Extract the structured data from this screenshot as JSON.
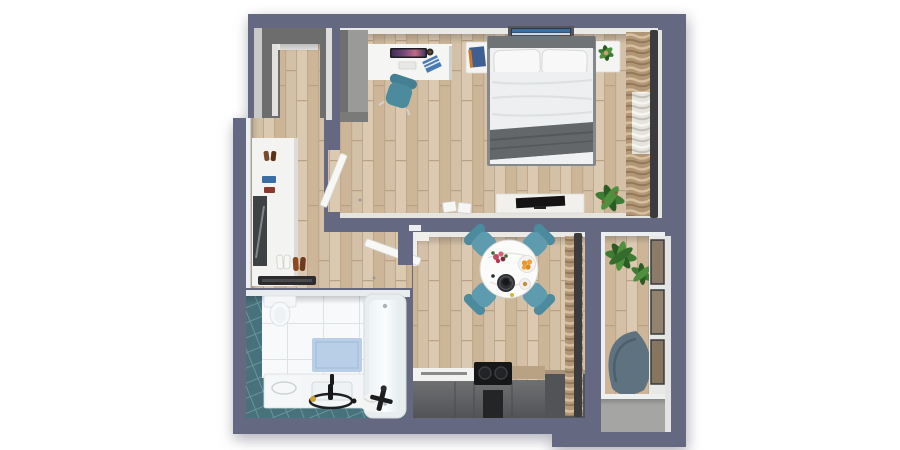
{
  "scene": {
    "name": "apartment-floor-plan-3d-top-view",
    "style": "photorealistic top-down render",
    "background": "#ffffff"
  },
  "colors": {
    "wall": "#646880",
    "floor_wood": "#d7c3aa",
    "trim": "#eae9e6",
    "closet_gray": "#6d6d6d",
    "wardrobe_gray": "#9a9a98",
    "chair_teal": "#5e9bae",
    "chair_teal_dark": "#4c8a9e",
    "bath_tile_teal": "#47717b",
    "bath_tile_white": "#f7f9fa",
    "bath_mat_blue": "#b9cfe7",
    "kitchen_cabinet": "#5d5f62",
    "kitchen_cabinet_dark": "#232527",
    "counter_white": "#f2f2f0",
    "counter_wood": "#b9a184",
    "curtain_tan": "#b29777",
    "curtain_rod": "#3b3b3d",
    "plant_green": "#3e7b33",
    "bed_linen": "#eef0f1",
    "bed_blanket": "#63676a",
    "bed_frame": "#85898c",
    "lounge_chair": "#5f7280",
    "balcony_glass": "#8b7b68",
    "table_white": "#fbfbf9",
    "fruit_orange": "#e8962e",
    "flower_red": "#c04a62",
    "book_blue": "#3f5f93",
    "mirror_dark": "#3f4245",
    "shoe_brown": "#8a4a26",
    "tv_black": "#141415",
    "doormat_black": "#2c2c2e"
  },
  "rooms": [
    {
      "id": "bedroom",
      "label": "Bedroom",
      "furniture": [
        "double-bed",
        "headboard",
        "pillows",
        "gray-blanket",
        "nightstand-left",
        "nightstand-right",
        "wall-art",
        "desk",
        "monitor",
        "keyboard",
        "desk-chair",
        "tall-wardrobe",
        "window-curtains",
        "potted-plant",
        "tv-bench",
        "tv",
        "shoe-boxes",
        "door"
      ]
    },
    {
      "id": "walk-in-closet",
      "label": "Walk-in Closet",
      "furniture": [
        "shelving-unit"
      ]
    },
    {
      "id": "entry-hall",
      "label": "Entry Hall",
      "furniture": [
        "white-wardrobe",
        "mirror",
        "shelf-shoes",
        "floor-shoes",
        "doormat",
        "entry-door"
      ]
    },
    {
      "id": "living-dining",
      "label": "Living / Dining Room",
      "furniture": [
        "round-dining-table",
        "dining-chairs-x4",
        "flower-vase",
        "fruit-bowl",
        "dark-plate-with-cup",
        "side-plate",
        "window-curtains"
      ]
    },
    {
      "id": "kitchen",
      "label": "Kitchen",
      "furniture": [
        "base-cabinets",
        "cooktop",
        "white-counter",
        "wood-counter",
        "tall-dark-cabinet"
      ]
    },
    {
      "id": "bathroom",
      "label": "Bathroom",
      "furniture": [
        "toilet",
        "bathtub",
        "washing-machine",
        "sink-vanity",
        "bath-mat",
        "black-faucet",
        "floor-ring",
        "shower-set",
        "towel"
      ]
    },
    {
      "id": "balcony",
      "label": "Balcony",
      "furniture": [
        "potted-plants",
        "lounge-chair",
        "glass-railing",
        "floor-step"
      ]
    }
  ]
}
